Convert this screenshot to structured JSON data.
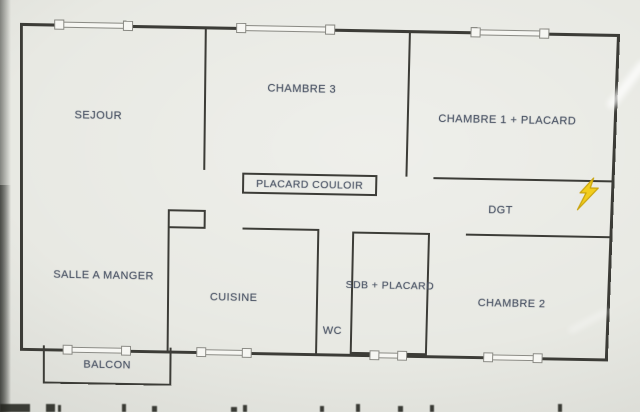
{
  "document": {
    "type": "floor-plan-photo",
    "description_visible_content_only": true
  },
  "labels": {
    "sejour": "SEJOUR",
    "chambre3": "CHAMBRE 3",
    "chambre1": "CHAMBRE 1 + PLACARD",
    "placard_couloir": "PLACARD COULOIR",
    "dgt": "DGT",
    "salle_a_manger": "SALLE A MANGER",
    "cuisine": "CUISINE",
    "sdb": "SDB + PLACARD",
    "wc": "WC",
    "chambre2": "CHAMBRE 2",
    "balcon": "BALCON"
  },
  "icons": {
    "lightning": "lightning-bolt-icon"
  },
  "colors": {
    "background": "#e8e9e3",
    "wall": "#3c3c37",
    "label_text": "#4b5465",
    "bolt_fill": "#f2cd1c",
    "bolt_outline": "#c9a40f",
    "window_frame": "#8a8a84",
    "window_fill": "#f6f6f2"
  }
}
